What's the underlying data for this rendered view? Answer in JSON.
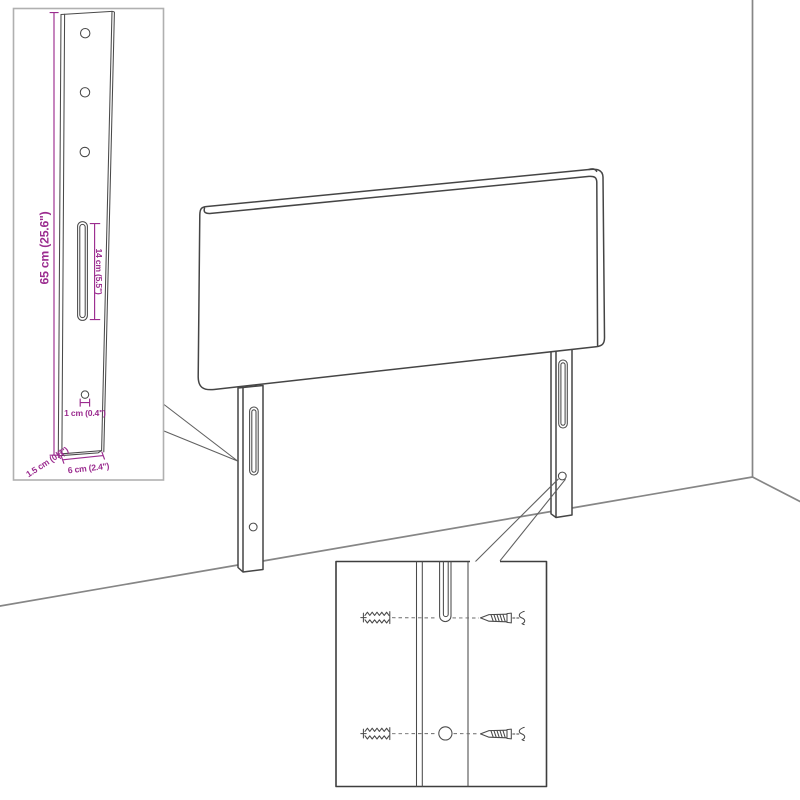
{
  "diagram": {
    "title": "headboard assembly dimension diagram",
    "colors": {
      "dimension_accent": "#9b2c8f",
      "drawing_line": "#454545",
      "wall_line": "#868686",
      "detail_box_light": "#b0b0b0",
      "detail_box_dark": "#3e3e3e",
      "background": "#ffffff"
    },
    "detail_leg": {
      "dimensions": {
        "leg_height": "65 cm (25.6\")",
        "slot_length": "14 cm (5.5\")",
        "hole_diameter": "1 cm (0.4\")",
        "leg_thickness": "1.5 cm (0.6\")",
        "leg_width": "6 cm (2.4\")"
      }
    },
    "detail_mounting": {
      "parts": {
        "top_left": "wall-plug",
        "top_right": "screw",
        "bottom_left": "wall-plug",
        "bottom_right": "screw"
      }
    }
  }
}
